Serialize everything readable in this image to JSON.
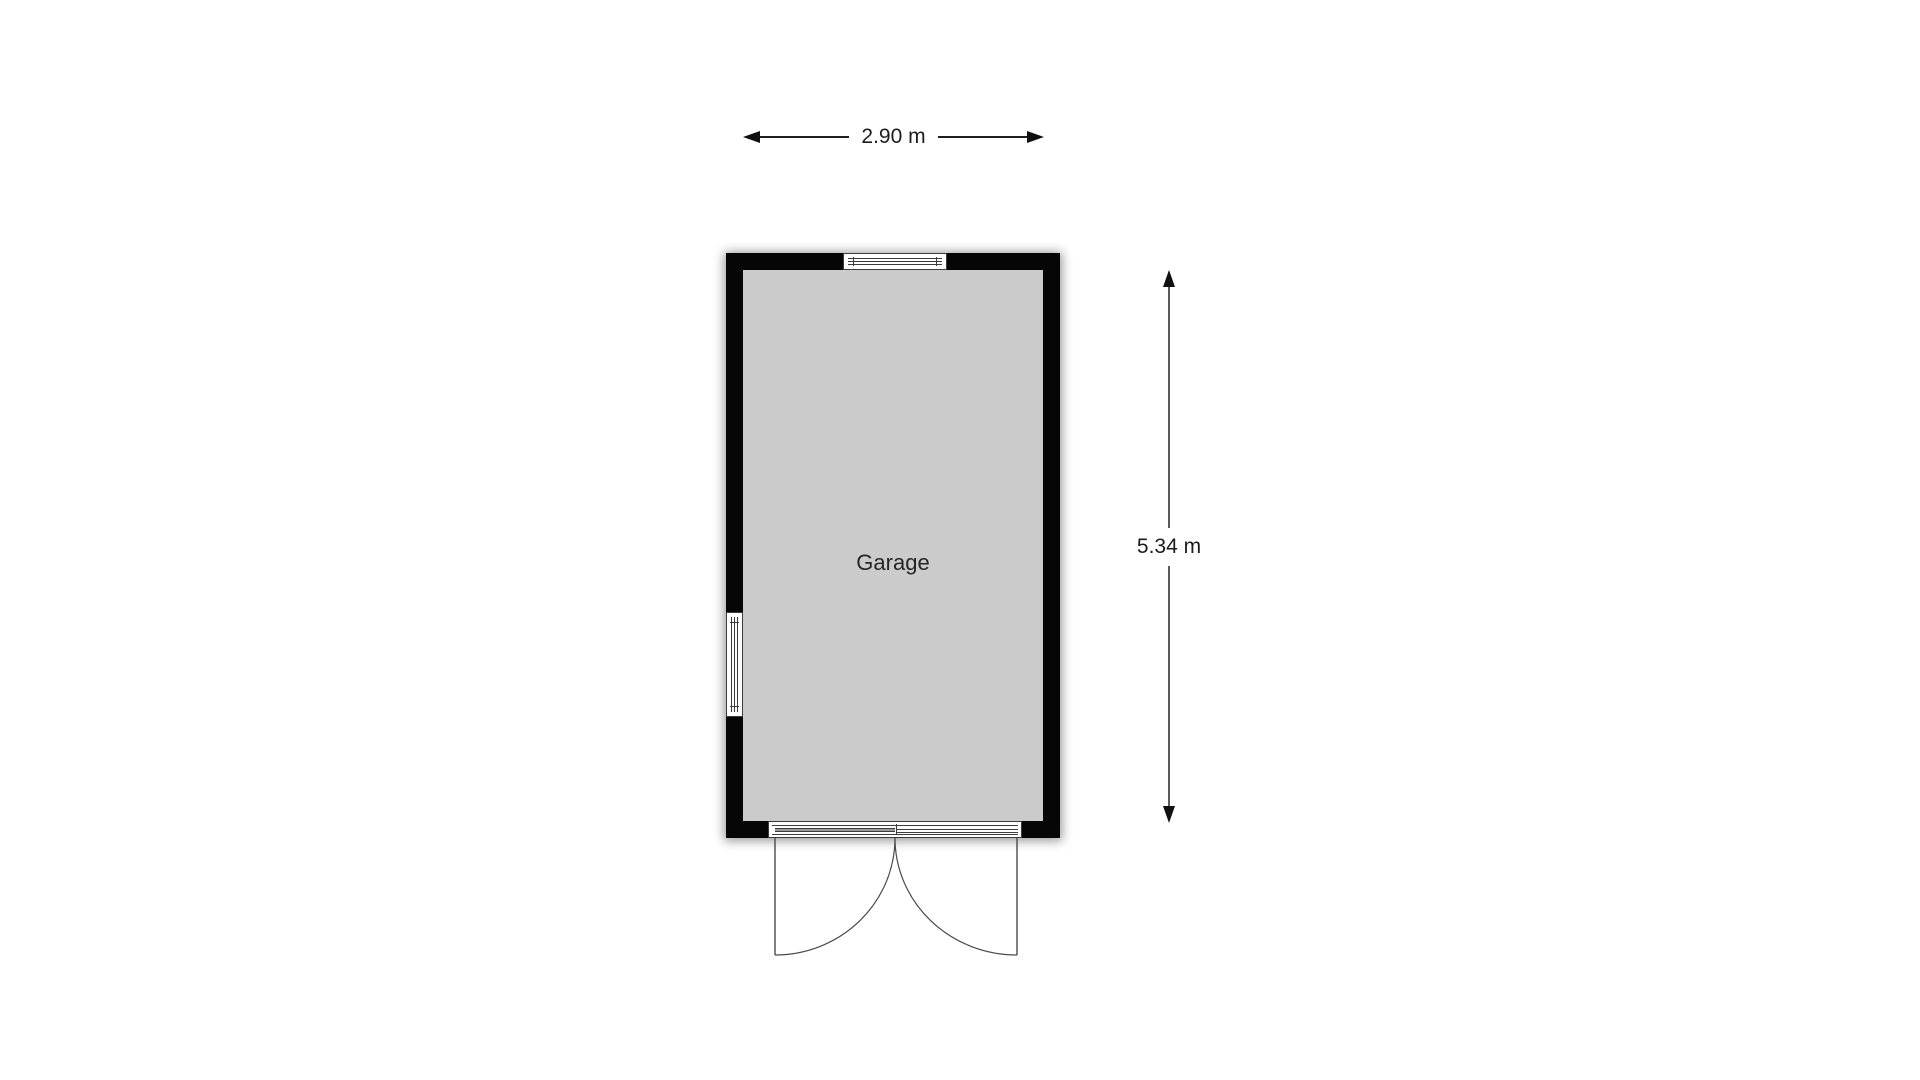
{
  "page": {
    "background_color": "#ffffff"
  },
  "floor_plan": {
    "room_label": "Garage",
    "wall_color": "#000000",
    "floor_color": "#cbcbcb",
    "features": [
      "window-top",
      "window-left",
      "double-garage-door-bottom"
    ]
  },
  "dimensions": {
    "width_label": "2.90 m",
    "height_label": "5.34 m"
  }
}
